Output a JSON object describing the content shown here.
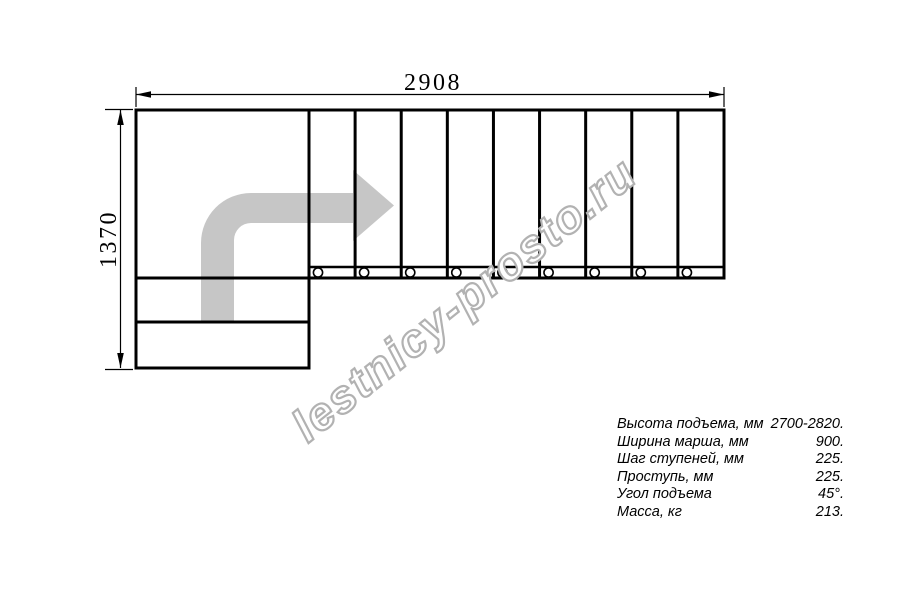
{
  "page": {
    "background": "#ffffff"
  },
  "drawing": {
    "top_dimension": "2908",
    "left_dimension": "1370",
    "flight_steps": 9,
    "entry_steps": 2,
    "line_color": "#000000",
    "arrow_color": "#c6c6c6"
  },
  "watermark": {
    "text": "lestnicy-prosto.ru",
    "color": "#b2b2b2"
  },
  "specs": {
    "rows": [
      {
        "label": "Высота подъема, мм",
        "value": "2700-2820."
      },
      {
        "label": "Ширина марша, мм",
        "value": "900."
      },
      {
        "label": "Шаг ступеней, мм",
        "value": "225."
      },
      {
        "label": "Проступь, мм",
        "value": "225."
      },
      {
        "label": "Угол подъема",
        "value": "45°."
      },
      {
        "label": "Масса, кг",
        "value": "213."
      }
    ]
  }
}
